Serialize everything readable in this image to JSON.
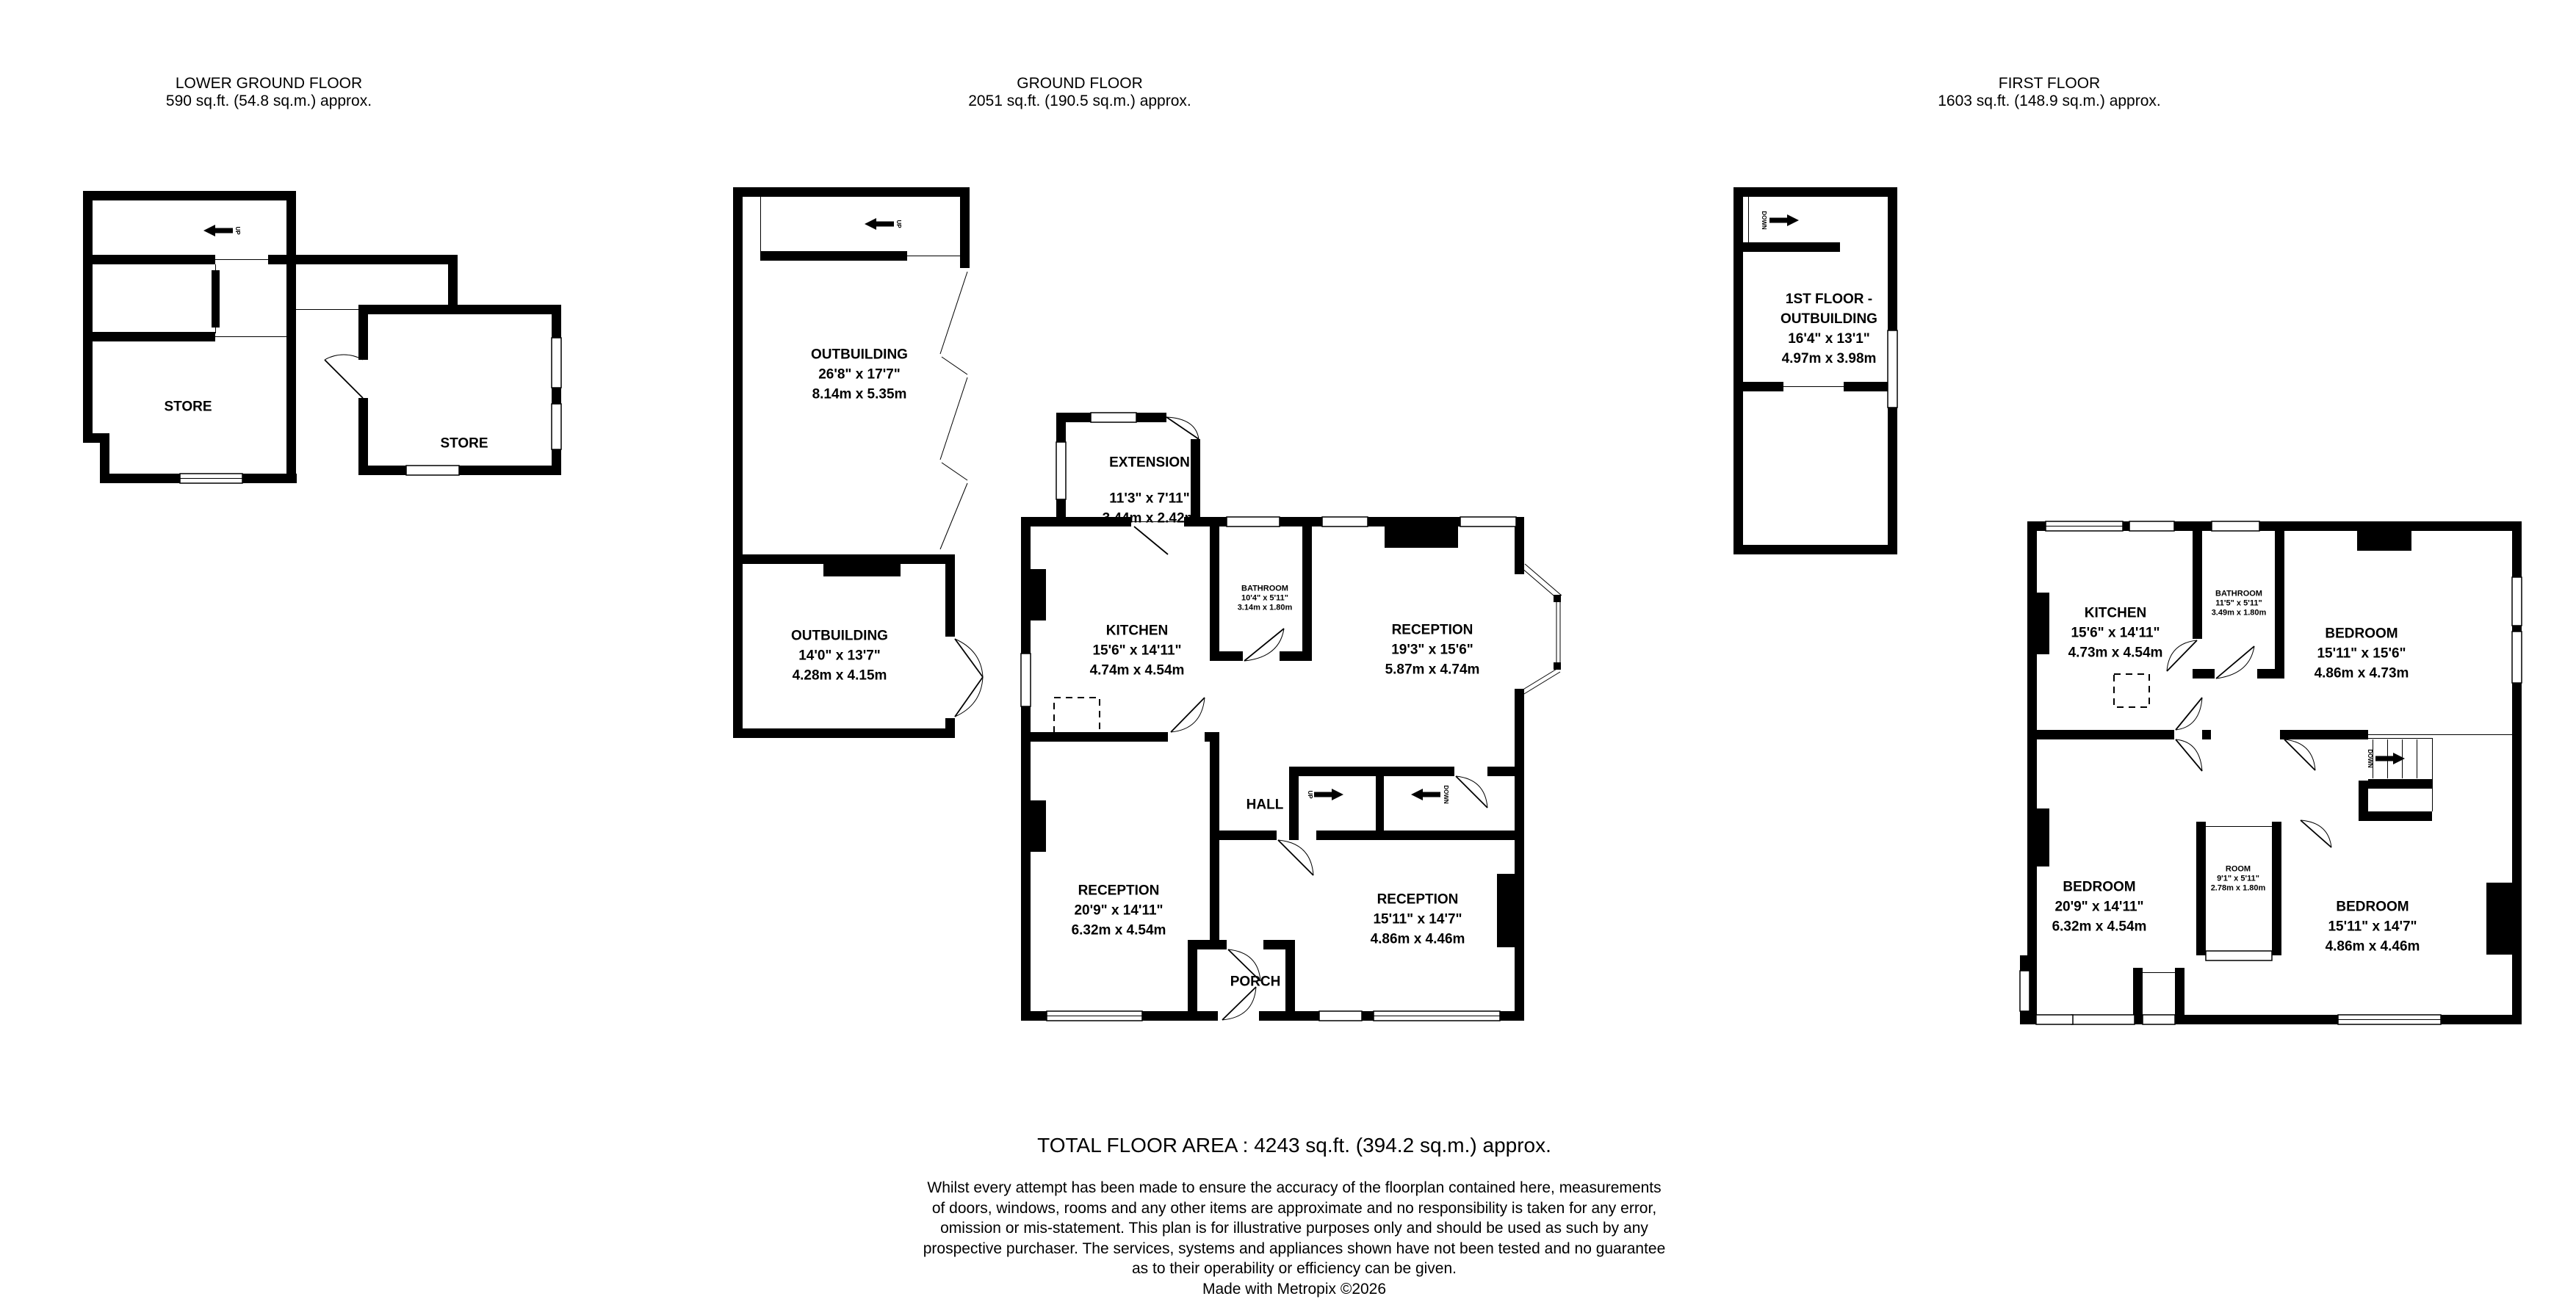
{
  "page": {
    "background": "#ffffff",
    "line_color": "#000000"
  },
  "floors": {
    "lower_ground": {
      "title": "LOWER GROUND FLOOR",
      "area": "590 sq.ft. (54.8 sq.m.) approx.",
      "rooms": {
        "store_left": {
          "name": "STORE"
        },
        "store_right": {
          "name": "STORE"
        }
      },
      "stairs": {
        "up_label": "UP"
      }
    },
    "ground": {
      "title": "GROUND FLOOR",
      "area": "2051 sq.ft. (190.5 sq.m.) approx.",
      "rooms": {
        "outbuilding_large": {
          "name": "OUTBUILDING",
          "imperial": "26'8\" x 17'7\"",
          "metric": "8.14m x 5.35m"
        },
        "outbuilding_small": {
          "name": "OUTBUILDING",
          "imperial": "14'0\" x 13'7\"",
          "metric": "4.28m x 4.15m"
        },
        "extension": {
          "name": "EXTENSION",
          "imperial": "11'3\" x 7'11\"",
          "metric": "3.44m x 2.42m"
        },
        "kitchen": {
          "name": "KITCHEN",
          "imperial": "15'6\" x 14'11\"",
          "metric": "4.74m x 4.54m"
        },
        "bathroom": {
          "name": "BATHROOM",
          "imperial": "10'4\" x 5'11\"",
          "metric": "3.14m x 1.80m"
        },
        "reception_top": {
          "name": "RECEPTION",
          "imperial": "19'3\" x 15'6\"",
          "metric": "5.87m x 4.74m"
        },
        "hall": {
          "name": "HALL"
        },
        "reception_left": {
          "name": "RECEPTION",
          "imperial": "20'9\" x 14'11\"",
          "metric": "6.32m x 4.54m"
        },
        "reception_right": {
          "name": "RECEPTION",
          "imperial": "15'11\" x 14'7\"",
          "metric": "4.86m x 4.46m"
        },
        "porch": {
          "name": "PORCH"
        }
      },
      "stairs": {
        "up_label": "UP",
        "down_label": "DOWN",
        "outbuilding_up_label": "UP"
      }
    },
    "first": {
      "title": "FIRST FLOOR",
      "area": "1603 sq.ft. (148.9 sq.m.) approx.",
      "rooms": {
        "outbuilding": {
          "name_line1": "1ST FLOOR -",
          "name_line2": "OUTBUILDING",
          "imperial": "16'4\" x 13'1\"",
          "metric": "4.97m x 3.98m"
        },
        "kitchen": {
          "name": "KITCHEN",
          "imperial": "15'6\" x 14'11\"",
          "metric": "4.73m x 4.54m"
        },
        "bathroom": {
          "name": "BATHROOM",
          "imperial": "11'5\" x 5'11\"",
          "metric": "3.49m x 1.80m"
        },
        "bedroom_top": {
          "name": "BEDROOM",
          "imperial": "15'11\" x 15'6\"",
          "metric": "4.86m x 4.73m"
        },
        "bedroom_left": {
          "name": "BEDROOM",
          "imperial": "20'9\" x 14'11\"",
          "metric": "6.32m x 4.54m"
        },
        "room": {
          "name": "ROOM",
          "imperial": "9'1\" x 5'11\"",
          "metric": "2.78m x 1.80m"
        },
        "bedroom_right": {
          "name": "BEDROOM",
          "imperial": "15'11\" x 14'7\"",
          "metric": "4.86m x 4.46m"
        }
      },
      "stairs": {
        "down_label": "DOWN",
        "outbuilding_down_label": "DOWN"
      }
    }
  },
  "footer": {
    "total_area": "TOTAL FLOOR AREA : 4243 sq.ft. (394.2 sq.m.) approx.",
    "disclaimer_lines": [
      "Whilst every attempt has been made to ensure the accuracy of the floorplan contained here, measurements",
      "of doors, windows, rooms and any other items are approximate and no responsibility is taken for any error,",
      "omission or mis-statement. This plan is for illustrative purposes only and should be used as such by any",
      "prospective purchaser. The services, systems and appliances shown have not been tested and no guarantee",
      "as to their operability or efficiency can be given.",
      ""
    ],
    "credit": "Made with Metropix ©2026"
  }
}
